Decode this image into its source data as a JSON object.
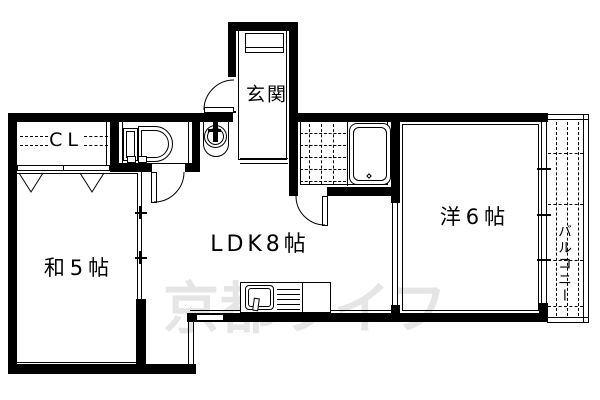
{
  "plan": {
    "labels": {
      "entrance": "玄関",
      "closet": "CL",
      "japanese_room": "和5帖",
      "ldk": "LDK8帖",
      "western_room": "洋6帖",
      "balcony": "バルコニー"
    },
    "watermark": "京都ライフ",
    "colors": {
      "wall": "#000000",
      "background": "#ffffff",
      "watermark": "#e5e5e5"
    }
  }
}
